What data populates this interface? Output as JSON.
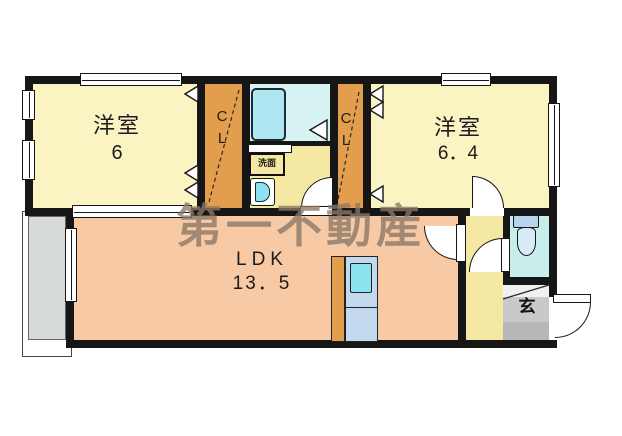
{
  "watermark": "第一不動産",
  "rooms": {
    "bedroom_left": {
      "name": "洋室",
      "size": "6"
    },
    "bedroom_right": {
      "name": "洋室",
      "size": "6．4"
    },
    "ldk": {
      "name": "LDK",
      "size": "13．5"
    },
    "closet_left": {
      "label": "CL"
    },
    "closet_right": {
      "label": "CL"
    },
    "entrance": {
      "label": "玄"
    },
    "washroom": {
      "label": "洗面"
    }
  },
  "colors": {
    "wall": "#161616",
    "bedroom": "#faf3c2",
    "closet": "#e29d4d",
    "ldk": "#f7c9a4",
    "hall": "#f4e8a3",
    "bath": "#d7f3f3",
    "tub": "#aee6f1",
    "toiletFloor": "#c8eeec",
    "toiletTank": "#b4d5ed",
    "toiletBowl": "#d8eaf6",
    "balcony": "#d7dbd7",
    "genkan": "#c9c9c9",
    "genkanDark": "#b7b7b7",
    "kitchen": "#c2d9f0",
    "sink": "#8ae3ef",
    "watermark": "#8b7867"
  }
}
